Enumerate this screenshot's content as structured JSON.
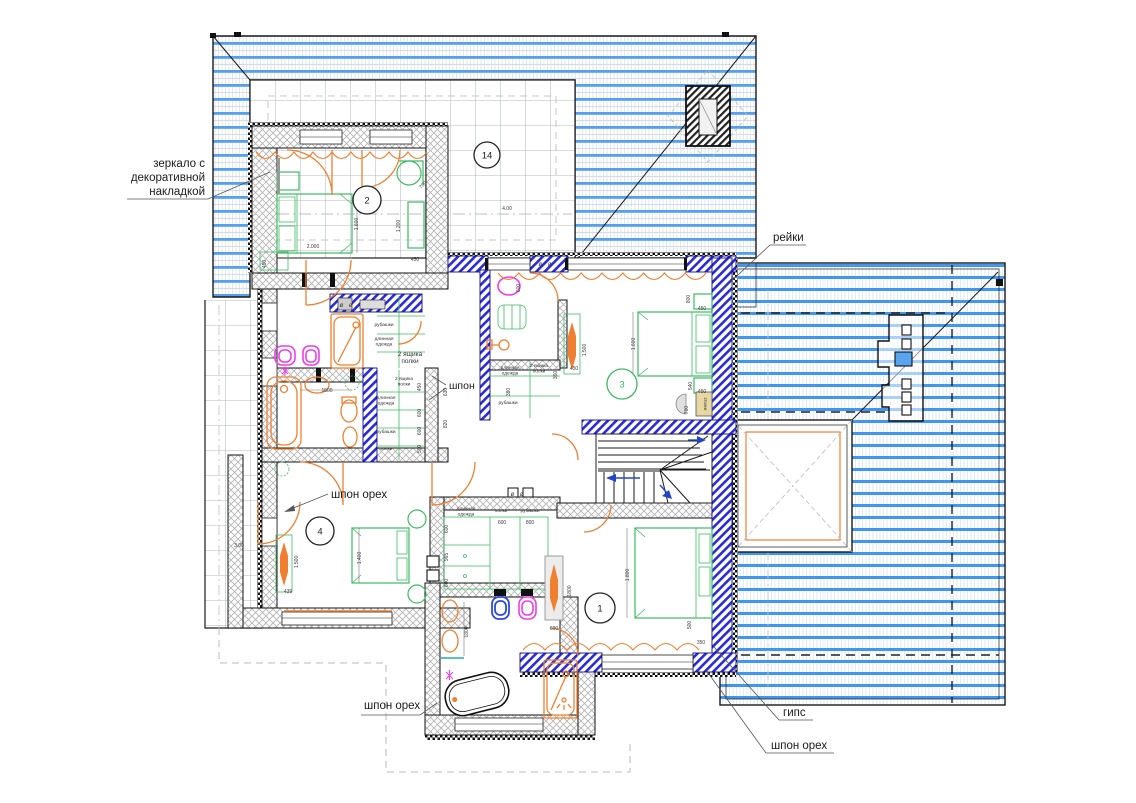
{
  "drawing": {
    "kind": "architectural floor plan (attic level with roof plan)",
    "language": "ru"
  },
  "colors": {
    "roof_stripe_blue": "#55a0ef",
    "roof_stripe_blue_bright": "#3f97f2",
    "partition_hatch_blue": "#2b2bd6",
    "furniture_green": "#3dbb63",
    "sanitary_orange": "#f08030",
    "sanitary_magenta": "#ee3dee",
    "sanitary_blue": "#2b48e0",
    "table_beige": "#e7d7a3",
    "wall_hatch_gray": "#b5b5b5"
  },
  "annotations": {
    "mirror_note": {
      "lines": [
        "зеркало с",
        "декоративной",
        "накладкой"
      ]
    },
    "reiki": {
      "text": "рейки"
    },
    "shpon": {
      "text": "шпон"
    },
    "shpon_oreh_room": {
      "text": "шпон орех"
    },
    "shpon_oreh_bottom": {
      "text": "шпон орех"
    },
    "gips": {
      "text": "гипс"
    },
    "shpon_oreh_right": {
      "text": "шпон орех"
    }
  },
  "room_markers": [
    {
      "label": "2",
      "x": 367,
      "y": 200,
      "r": 14,
      "color": "#222222"
    },
    {
      "label": "14",
      "x": 487,
      "y": 155,
      "r": 13,
      "color": "#222222"
    },
    {
      "label": "3",
      "x": 622,
      "y": 384,
      "r": 15,
      "color": "#3dbb63"
    },
    {
      "label": "4",
      "x": 320,
      "y": 531,
      "r": 14,
      "color": "#222222"
    },
    {
      "label": "1",
      "x": 600,
      "y": 608,
      "r": 15,
      "color": "#222222"
    }
  ],
  "closet_labels": [
    {
      "lines": [
        "рубашки"
      ],
      "x": 384,
      "y": 326
    },
    {
      "lines": [
        "длинная",
        "одежда"
      ],
      "x": 384,
      "y": 340
    },
    {
      "lines": [
        "2 ящика",
        "полки"
      ],
      "x": 410,
      "y": 356,
      "size": 6.5
    },
    {
      "lines": [
        "2 ящика",
        "полки"
      ],
      "x": 404,
      "y": 380
    },
    {
      "lines": [
        "длинная",
        "одежда"
      ],
      "x": 386,
      "y": 399
    },
    {
      "lines": [
        "рубашки"
      ],
      "x": 386,
      "y": 433
    },
    {
      "lines": [
        "полки"
      ],
      "x": 386,
      "y": 450
    },
    {
      "lines": [
        "длинная",
        "одежда"
      ],
      "x": 510,
      "y": 369
    },
    {
      "lines": [
        "2 ящика",
        "полки"
      ],
      "x": 539,
      "y": 367
    },
    {
      "lines": [
        "рубашки"
      ],
      "x": 508,
      "y": 404
    },
    {
      "lines": [
        "длинная",
        "одежда"
      ],
      "x": 466,
      "y": 510
    },
    {
      "lines": [
        "полки"
      ],
      "x": 501,
      "y": 512
    },
    {
      "lines": [
        "рубашки"
      ],
      "x": 530,
      "y": 512
    },
    {
      "lines": [
        "столик"
      ],
      "x": 704,
      "y": 404,
      "rot": 90,
      "size": 4.2,
      "color": "#8a6d1f"
    }
  ],
  "dimensions": [
    {
      "t": "2.000",
      "x": 313,
      "y": 248,
      "r": 0
    },
    {
      "t": "1.600",
      "x": 358,
      "y": 224,
      "r": -90
    },
    {
      "t": "1.200",
      "x": 400,
      "y": 226,
      "r": -90
    },
    {
      "t": "450",
      "x": 415,
      "y": 261,
      "r": 0
    },
    {
      "t": "450",
      "x": 266,
      "y": 264,
      "r": -90
    },
    {
      "t": "700",
      "x": 424,
      "y": 186,
      "r": -45
    },
    {
      "t": "4.00",
      "x": 507,
      "y": 210,
      "r": 0
    },
    {
      "t": "3.00",
      "x": 239,
      "y": 547,
      "r": 0
    },
    {
      "t": "1500",
      "x": 327,
      "y": 392,
      "r": 0
    },
    {
      "t": "450",
      "x": 421,
      "y": 387,
      "r": -90
    },
    {
      "t": "600",
      "x": 421,
      "y": 413,
      "r": -90
    },
    {
      "t": "600",
      "x": 421,
      "y": 431,
      "r": -90
    },
    {
      "t": "500",
      "x": 421,
      "y": 449,
      "r": -90
    },
    {
      "t": "630",
      "x": 447,
      "y": 392,
      "r": -90
    },
    {
      "t": "820",
      "x": 447,
      "y": 424,
      "r": -90
    },
    {
      "t": "600",
      "x": 520,
      "y": 288,
      "r": -90
    },
    {
      "t": "350",
      "x": 557,
      "y": 375,
      "r": -90
    },
    {
      "t": "380",
      "x": 510,
      "y": 392,
      "r": -90
    },
    {
      "t": "1.500",
      "x": 586,
      "y": 350,
      "r": -90
    },
    {
      "t": "450",
      "x": 574,
      "y": 370,
      "r": 0
    },
    {
      "t": "800",
      "x": 690,
      "y": 299,
      "r": -90
    },
    {
      "t": "450",
      "x": 702,
      "y": 310,
      "r": 0
    },
    {
      "t": "1.600",
      "x": 635,
      "y": 344,
      "r": -90
    },
    {
      "t": "540",
      "x": 692,
      "y": 386,
      "r": -90
    },
    {
      "t": "450",
      "x": 702,
      "y": 393,
      "r": 0
    },
    {
      "t": "700",
      "x": 688,
      "y": 410,
      "r": -90
    },
    {
      "t": "1.400",
      "x": 361,
      "y": 558,
      "r": -90
    },
    {
      "t": "439",
      "x": 288,
      "y": 593,
      "r": 0
    },
    {
      "t": "1.500",
      "x": 298,
      "y": 562,
      "r": -90
    },
    {
      "t": "600",
      "x": 448,
      "y": 529,
      "r": -90
    },
    {
      "t": "965",
      "x": 448,
      "y": 557,
      "r": -90
    },
    {
      "t": "600",
      "x": 448,
      "y": 583,
      "r": -90
    },
    {
      "t": "600",
      "x": 502,
      "y": 524,
      "r": 0
    },
    {
      "t": "800",
      "x": 530,
      "y": 524,
      "r": 0
    },
    {
      "t": "600",
      "x": 554,
      "y": 630,
      "r": 0
    },
    {
      "t": "1800",
      "x": 571,
      "y": 591,
      "r": -90
    },
    {
      "t": "1800",
      "x": 468,
      "y": 632,
      "r": -90
    },
    {
      "t": "1.800",
      "x": 629,
      "y": 575,
      "r": -90
    },
    {
      "t": "500",
      "x": 691,
      "y": 625,
      "r": -90
    },
    {
      "t": "350",
      "x": 701,
      "y": 644,
      "r": 0
    }
  ],
  "vent_symbols": [
    {
      "t": "ø ø",
      "x": 347,
      "y": 307
    },
    {
      "t": "ø ø",
      "x": 546,
      "y": 266
    },
    {
      "t": "ø ø",
      "x": 518,
      "y": 496
    }
  ]
}
